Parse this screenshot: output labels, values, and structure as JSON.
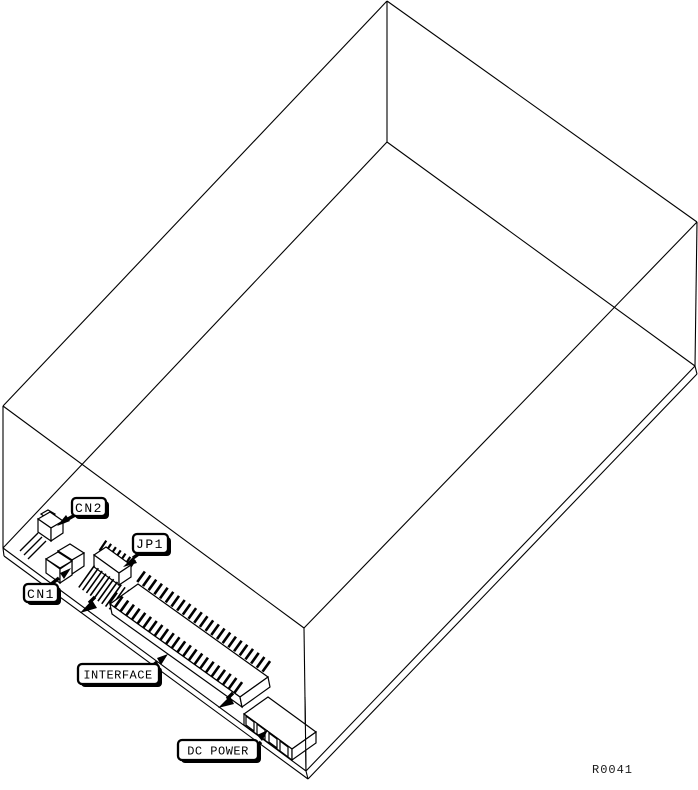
{
  "diagram": {
    "background": "#ffffff",
    "line_color": "#000000",
    "ref_code": "R0041",
    "callouts": {
      "cn2": {
        "label": "CN2"
      },
      "cn1": {
        "label": "CN1"
      },
      "jp1": {
        "label": "JP1"
      },
      "interface": {
        "label": "INTERFACE"
      },
      "dc_power": {
        "label": "DC POWER"
      }
    }
  }
}
